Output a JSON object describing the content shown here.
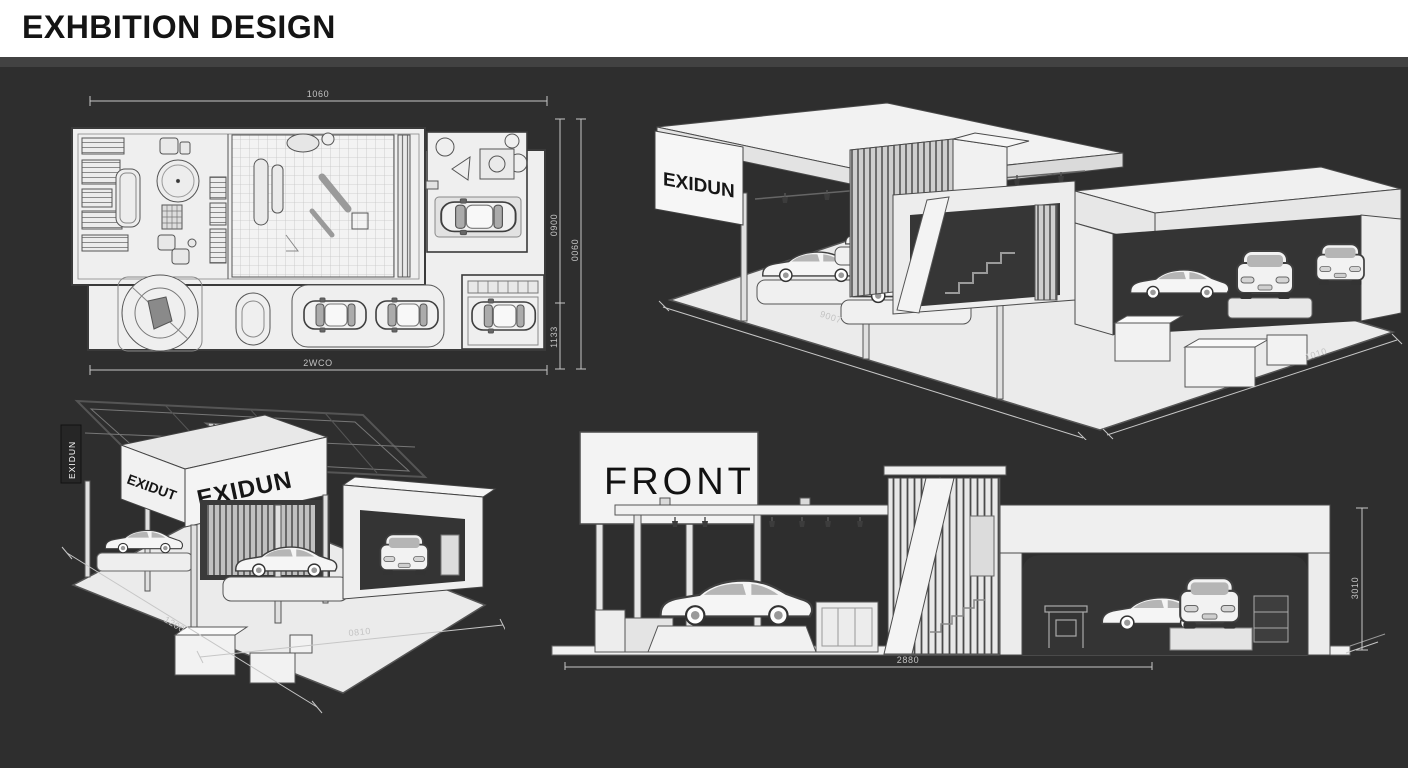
{
  "header": {
    "title": "EXHBITION DESIGN"
  },
  "colors": {
    "background": "#2e2e2e",
    "header_bg": "#ffffff",
    "divider": "#424242",
    "drawing_fill": "#f0f0f0",
    "drawing_stroke": "#3f3f3f",
    "opening_dark": "#343434",
    "dim_line": "#c6c6c6"
  },
  "views": {
    "floor_plan": {
      "dim_top": "1060",
      "dim_bottom": "2WCO",
      "dim_right_inner_upper": "0900",
      "dim_right_inner_lower": "1133",
      "dim_right_outer": "0060"
    },
    "iso_right": {
      "sign": "EXIDUN",
      "dim_left": "9007",
      "dim_right": "1010"
    },
    "iso_left": {
      "sign_side": "EXIDUT",
      "sign_front": "EXIDUN",
      "sign_vertical": "EXIDUN",
      "dim_left": "1200",
      "dim_bottom": "0810"
    },
    "front_elevation": {
      "label": "FRONT",
      "dim_bottom": "2880",
      "dim_right": "3010"
    }
  }
}
